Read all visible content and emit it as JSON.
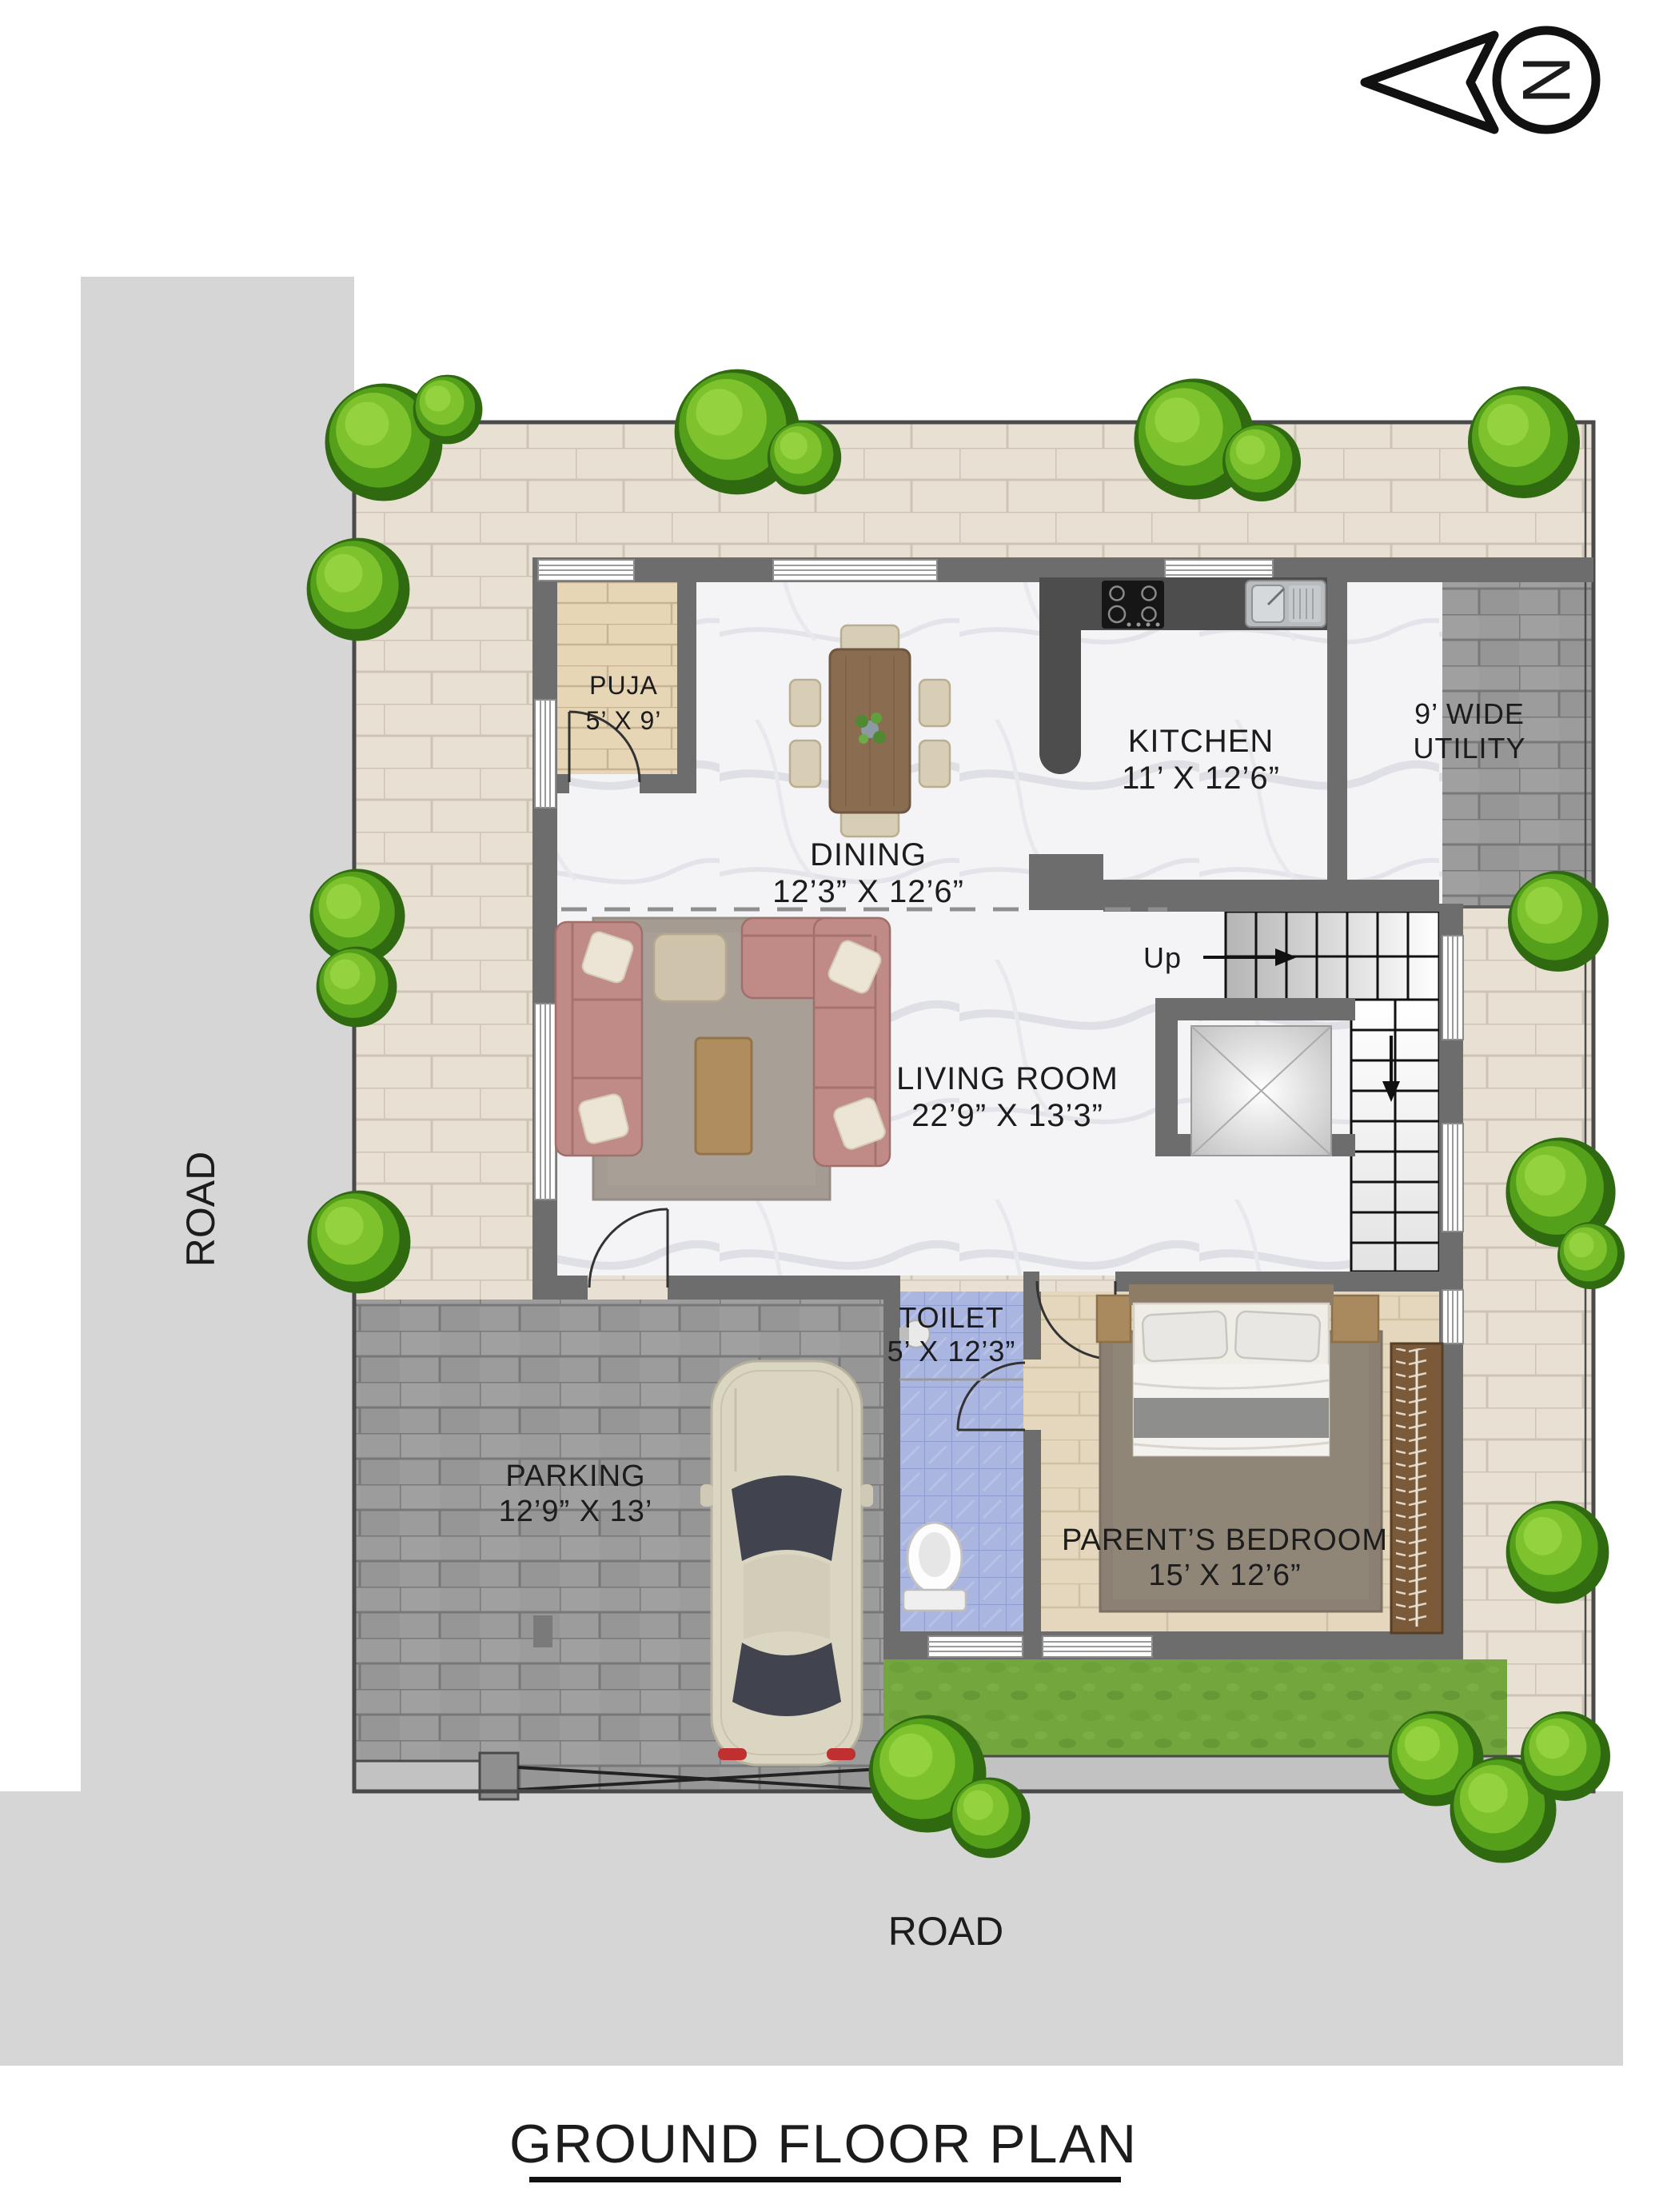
{
  "title": "GROUND FLOOR PLAN",
  "compass": {
    "north_label": "N"
  },
  "roads": {
    "left_label": "ROAD",
    "bottom_label": "ROAD"
  },
  "stairs": {
    "up_label": "Up"
  },
  "rooms": {
    "puja": {
      "line1": "PUJA",
      "line2": "5’ X 9’"
    },
    "dining": {
      "line1": "DINING",
      "line2": "12’3” X 12’6”"
    },
    "kitchen": {
      "line1": "KITCHEN",
      "line2": "11’ X 12’6”"
    },
    "utility": {
      "line1": "9’ WIDE",
      "line2": "UTILITY"
    },
    "living": {
      "line1": "LIVING ROOM",
      "line2": "22’9” X 13’3”"
    },
    "toilet": {
      "line1": "TOILET",
      "line2": "5’ X 12’3”"
    },
    "parking": {
      "line1": "PARKING",
      "line2": "12’9” X 13’"
    },
    "bedroom": {
      "line1": "PARENT’S BEDROOM",
      "line2": "15’ X 12’6”"
    }
  },
  "colors": {
    "road": "#d6d6d6",
    "plot_paver": "#e7e0d3",
    "gray_paver": "#9c9c9c",
    "wall": "#6d6d6d",
    "grass": "#74a63e",
    "toilet_tile": "#aab6e0",
    "marble": "#f4f4f6",
    "puja_wood": "#e6d6b6",
    "bed_wood": "#e4d7bd",
    "sofa": "#c08b86",
    "label_text": "#1c1c1c"
  }
}
